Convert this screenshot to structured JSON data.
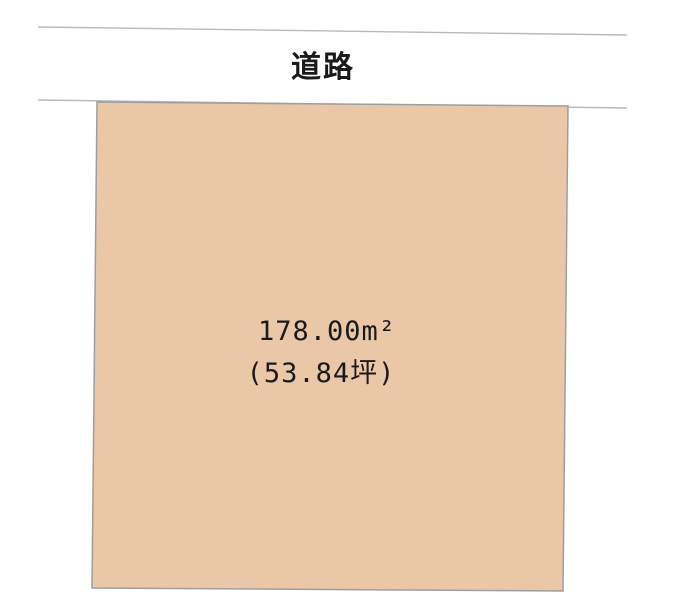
{
  "diagram": {
    "title": "land-parcel-plan",
    "road": {
      "label": "道路"
    },
    "parcel": {
      "area_m2": "178.00m²",
      "area_tsubo": "(53.84坪)"
    },
    "colors": {
      "parcel_fill": "#EAC7A6",
      "parcel_stroke": "#9E9E9E",
      "road_line": "#B9B9B9",
      "text": "#1A1A1A",
      "background": "#FFFFFF"
    }
  }
}
